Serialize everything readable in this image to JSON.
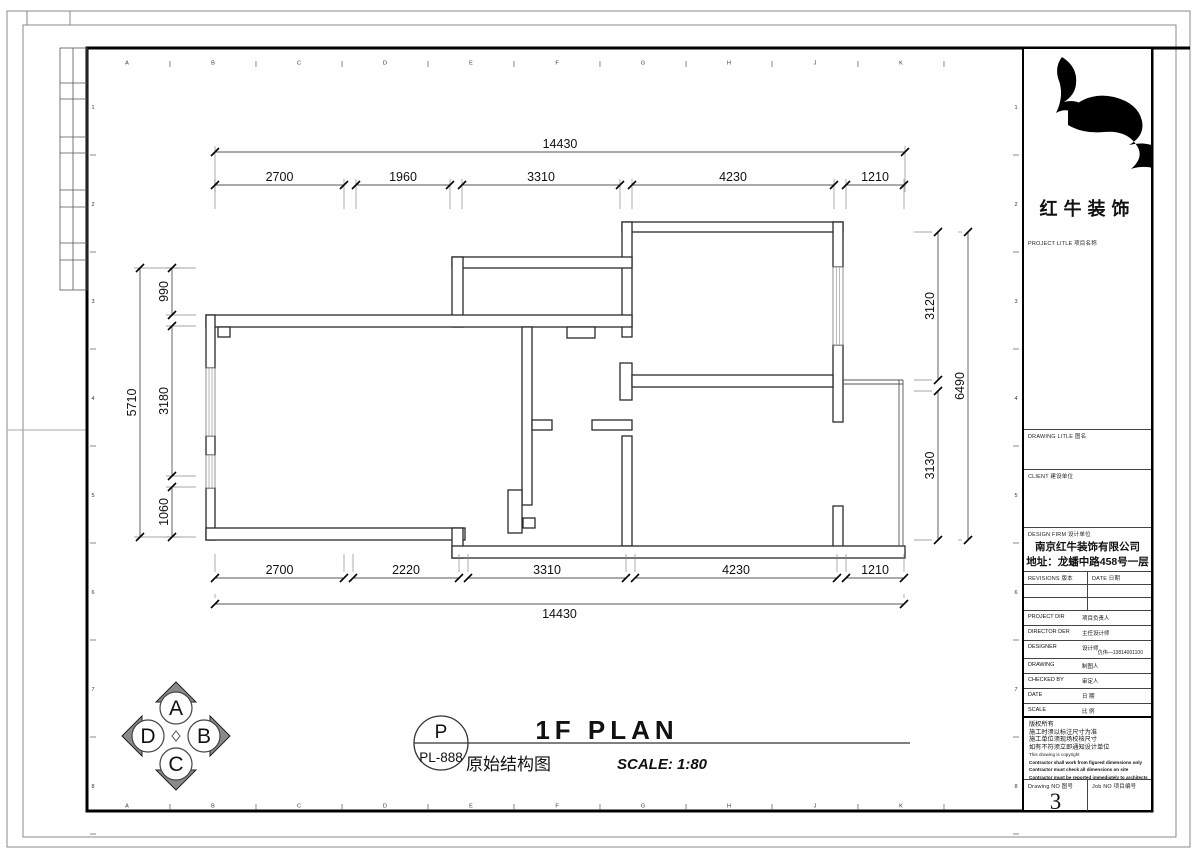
{
  "title_block": {
    "logo_text": "红牛装饰",
    "project_title_label": "PROJECT LITLE  项目名称",
    "drawing_title_label": "DRAWING LITLE  图名",
    "client_label": "CLIENT  建设单位",
    "design_firm_label": "DESIGN FIRM  设计单位",
    "design_firm_name": "南京红牛装饰有限公司",
    "design_firm_address": "地址：龙蟠中路458号一层",
    "revisions_label": "REVISIONS  版本",
    "date_col_label": "DATE  日期",
    "project_dir_label": "PROJECT DIR",
    "project_dir_cn": "项目负责人",
    "director_label": "DIRECTOR DER",
    "director_cn": "主任设计师",
    "designer_label": "DESIGNER",
    "designer_cn": "设计师",
    "designer_phone": "仇伟—13814001100",
    "drawing_by_label": "DRAWING",
    "drawing_by_cn": "制图人",
    "checked_by_label": "CHECKED BY",
    "checked_by_cn": "审定人",
    "date_label": "DATE",
    "date_cn": "日 期",
    "scale_label": "SCALE",
    "scale_cn": "比 例",
    "copyright_cn_lines": [
      "版权所有",
      "施工时须以标注尺寸为准",
      "施工单位须现场校核尺寸",
      "如有不符须立即通知设计单位"
    ],
    "copyright_en_line": "This drawing is copyright",
    "copyright_en_bold_lines": [
      "Contractor shall work from figured dimensions only",
      "Contractor must check all dimensions on site",
      "Contractor must be reported immediately to architects"
    ],
    "drawing_no_label": "Drawing NO  图号",
    "drawing_no": "3",
    "job_no_label": "Job NO  项目编号"
  },
  "drawing_caption": {
    "tag_letter": "P",
    "tag_code": "PL-888",
    "title": "1F PLAN",
    "subtitle_cn": "原始结构图",
    "scale_text": "SCALE: 1:80"
  },
  "compass": {
    "top": "A",
    "right": "B",
    "bottom": "C",
    "left": "D"
  },
  "grid_refs": {
    "columns": [
      "A",
      "B",
      "C",
      "D",
      "E",
      "F",
      "G",
      "H",
      "J",
      "K"
    ],
    "rows": [
      "1",
      "2",
      "3",
      "4",
      "5",
      "6",
      "7",
      "8"
    ]
  },
  "plan_dimensions": {
    "top_total": "14430",
    "top_segments": [
      "2700",
      "1960",
      "3310",
      "4230",
      "1210"
    ],
    "bottom_segments": [
      "2700",
      "2220",
      "3310",
      "4230",
      "1210"
    ],
    "bottom_total": "14430",
    "left_total": "5710",
    "left_segments": [
      "990",
      "3180",
      "1060"
    ],
    "right_segments": [
      "3120",
      "3130"
    ],
    "right_total": "6490"
  }
}
